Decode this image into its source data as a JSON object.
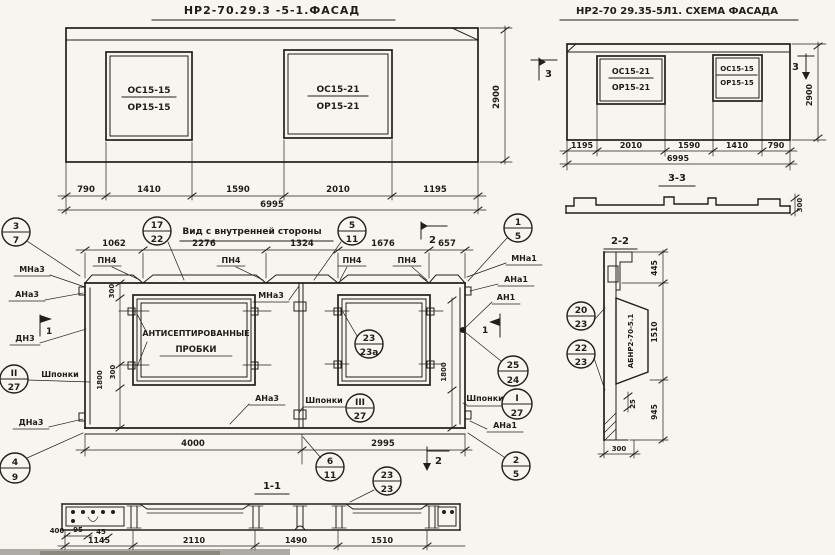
{
  "facade": {
    "title": "НР2-70.29.3 -5-1.ФАСАД",
    "win1": {
      "l1": "ОС15-15",
      "l2": "ОР15-15"
    },
    "win2": {
      "l1": "ОС15-21",
      "l2": "ОР15-21"
    },
    "dims": {
      "d1": "790",
      "d2": "1410",
      "d3": "1590",
      "d4": "2010",
      "d5": "1195",
      "total": "6995",
      "height": "2900"
    }
  },
  "schema": {
    "title": "НР2-70 29.35-5Л1. СХЕМА ФАСАДА",
    "win1": {
      "l1": "ОС15-21",
      "l2": "ОР15-21"
    },
    "win2": {
      "l1": "ОС15-15",
      "l2": "ОР15-15"
    },
    "dims": {
      "d1": "1195",
      "d2": "2010",
      "d3": "1590",
      "d4": "1410",
      "d5": "790",
      "total": "6995",
      "height": "2900"
    },
    "marker_left": "3",
    "marker_right": "3"
  },
  "section33": {
    "title": "3-3",
    "thickness": "300"
  },
  "inner": {
    "title": "Вид с внутренней стороны",
    "top_dims": {
      "d1": "1062",
      "d2": "2276",
      "d3": "1324",
      "d4": "1676",
      "d5": "657"
    },
    "bottom_dims": {
      "d1": "4000",
      "d2": "2995"
    },
    "left_dims": {
      "top": "300",
      "mid": "1800",
      "bot": "300"
    },
    "right_dim": "1800",
    "lintel": "ПН4",
    "note1": "АНТИСЕПТИРОВАННЫЕ",
    "note2": "ПРОБКИ",
    "keys_label": "Шпонки",
    "labels": {
      "mna3_top": "МНа3",
      "ana3_top": "АНа3",
      "dn3": "ДН3",
      "dna3": "ДНа3",
      "mna3_mid": "МНа3",
      "ana3_bot": "АНа3",
      "mna1": "МНа1",
      "ana1_top": "АНа1",
      "an1": "АН1",
      "ana1_bot": "АНа1"
    },
    "markers": {
      "sec1": "1",
      "sec2": "2"
    }
  },
  "s11": {
    "title": "1-1",
    "d400": "400",
    "d95": "95",
    "d45": "45",
    "d1145": "1145",
    "d2110": "2110",
    "d1490": "1490",
    "d1510": "1510"
  },
  "s22": {
    "title": "2-2",
    "mark": "АБНР2-70-5.1",
    "d445": "445",
    "d1510": "1510",
    "d945": "945",
    "d25": "25",
    "d300": "300"
  },
  "callouts": {
    "c3_7": {
      "t": "3",
      "b": "7"
    },
    "c17_22": {
      "t": "17",
      "b": "22"
    },
    "c5_11": {
      "t": "5",
      "b": "11"
    },
    "c1_5": {
      "t": "1",
      "b": "5"
    },
    "cII_27": {
      "t": "II",
      "b": "27"
    },
    "c23_23a": {
      "t": "23",
      "b": "23а"
    },
    "cIII_27": {
      "t": "III",
      "b": "27"
    },
    "c25_24": {
      "t": "25",
      "b": "24"
    },
    "cI_27": {
      "t": "I",
      "b": "27"
    },
    "c20_23": {
      "t": "20",
      "b": "23"
    },
    "c22_23": {
      "t": "22",
      "b": "23"
    },
    "c4_9": {
      "t": "4",
      "b": "9"
    },
    "c6_11": {
      "t": "6",
      "b": "11"
    },
    "c23_23": {
      "t": "23",
      "b": "23"
    },
    "c2_5": {
      "t": "2",
      "b": "5"
    }
  }
}
